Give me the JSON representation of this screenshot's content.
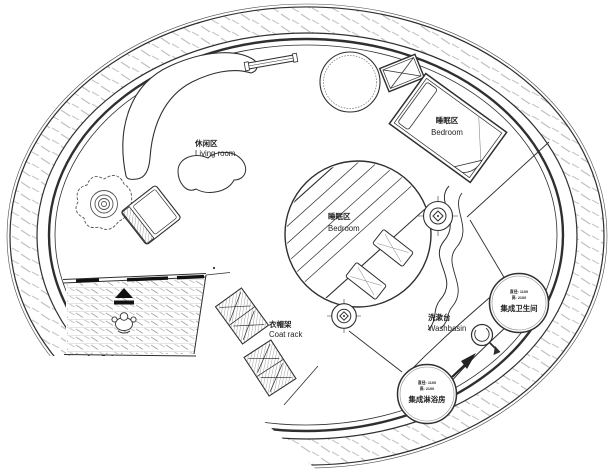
{
  "plan": {
    "living_room": {
      "label_zh": "休闲区",
      "label_en": "Living room"
    },
    "bedroom_main": {
      "label_zh": "睡眠区",
      "label_en": "Bedroom"
    },
    "bedroom_round": {
      "label_zh": "睡眠区",
      "label_en": "Bedroom"
    },
    "coat_rack": {
      "label_zh": "衣帽架",
      "label_en": "Coat rack"
    },
    "washbasin": {
      "label_zh": "洗漱台",
      "label_en": "Washbasin"
    },
    "toilet_pod": {
      "label": "集成卫生间",
      "dim_diameter": "直径: 1100",
      "dim_height": "高: 2100"
    },
    "shower_pod": {
      "label": "集成淋浴房",
      "dim_diameter": "直径: 1100",
      "dim_height": "高: 2100"
    }
  },
  "palette": {
    "line": "#2f2f2f",
    "ring_hatch": "#c0c0c0",
    "deck_hatch": "#a8a8a8",
    "black_fill": "#111111",
    "paper": "#ffffff"
  }
}
